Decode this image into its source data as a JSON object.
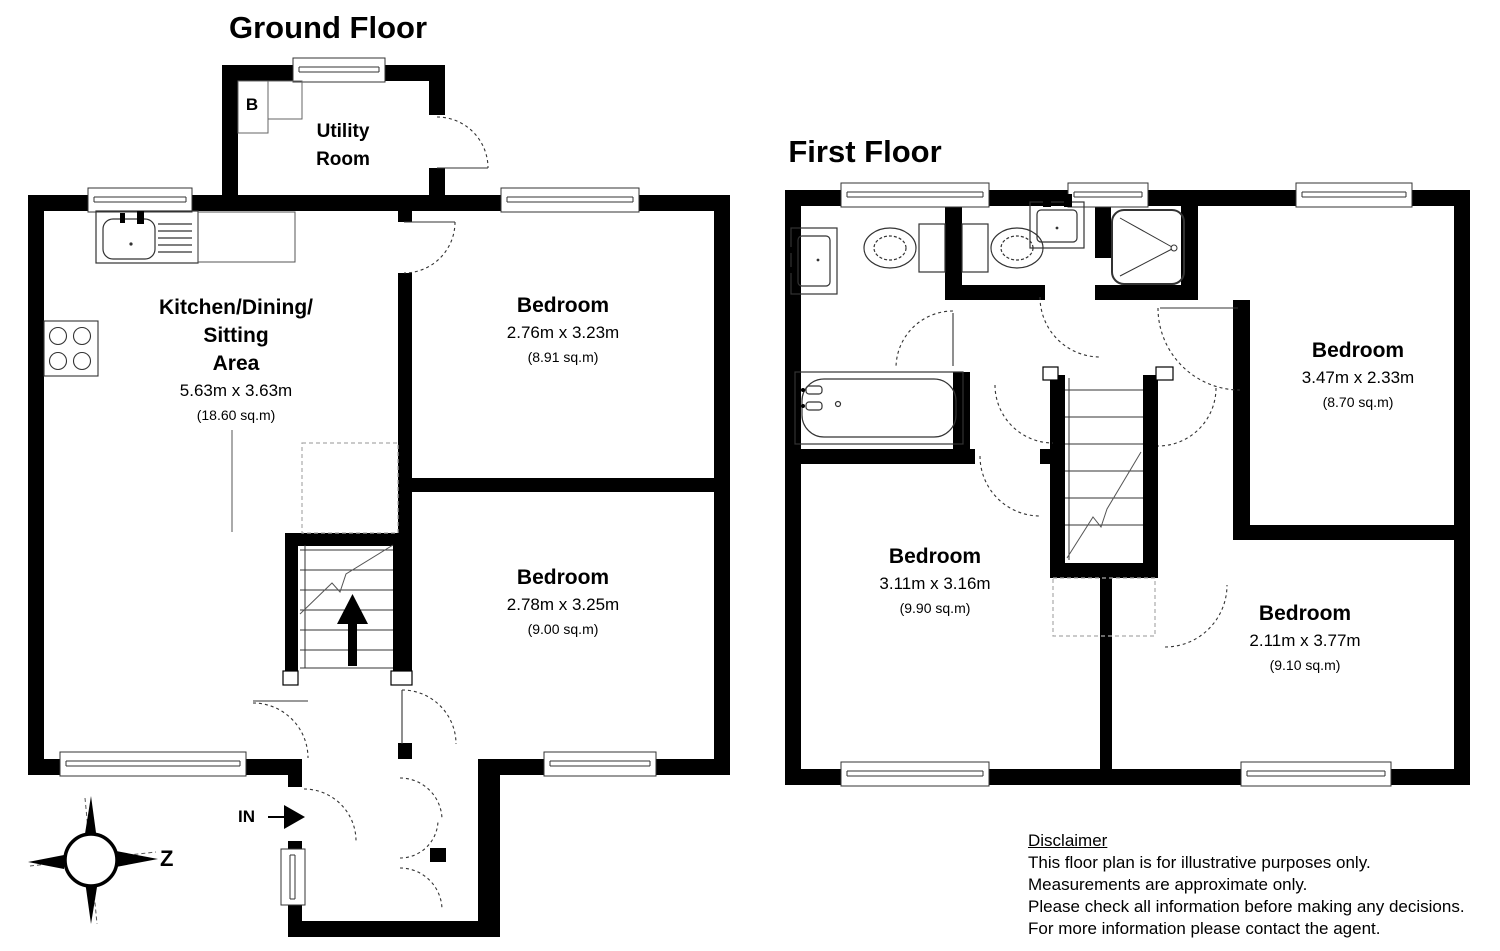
{
  "ground_floor": {
    "title": "Ground Floor",
    "utility": {
      "line1": "Utility",
      "line2": "Room"
    },
    "boiler_label": "B",
    "kitchen": {
      "line1": "Kitchen/Dining/",
      "line2": "Sitting",
      "line3": "Area",
      "dims": "5.63m x 3.63m",
      "area": "(18.60 sq.m)"
    },
    "bedroom_top": {
      "name": "Bedroom",
      "dims": "2.76m x 3.23m",
      "area": "(8.91 sq.m)"
    },
    "bedroom_bottom": {
      "name": "Bedroom",
      "dims": "2.78m x 3.25m",
      "area": "(9.00 sq.m)"
    },
    "entrance_label": "IN"
  },
  "first_floor": {
    "title": "First Floor",
    "bedroom_top_right": {
      "name": "Bedroom",
      "dims": "3.47m x 2.33m",
      "area": "(8.70 sq.m)"
    },
    "bedroom_bottom_left": {
      "name": "Bedroom",
      "dims": "3.11m x 3.16m",
      "area": "(9.90 sq.m)"
    },
    "bedroom_bottom_right": {
      "name": "Bedroom",
      "dims": "2.11m x 3.77m",
      "area": "(9.10 sq.m)"
    }
  },
  "compass": {
    "north_label": "Z"
  },
  "disclaimer": {
    "heading": "Disclaimer",
    "lines": [
      "This floor plan is for illustrative purposes only.",
      "Measurements are approximate only.",
      "Please check all information before making any decisions.",
      "For more information please contact the agent."
    ]
  },
  "colors": {
    "wall": "#000000",
    "line": "#333333",
    "dash": "#9a9a9a"
  }
}
